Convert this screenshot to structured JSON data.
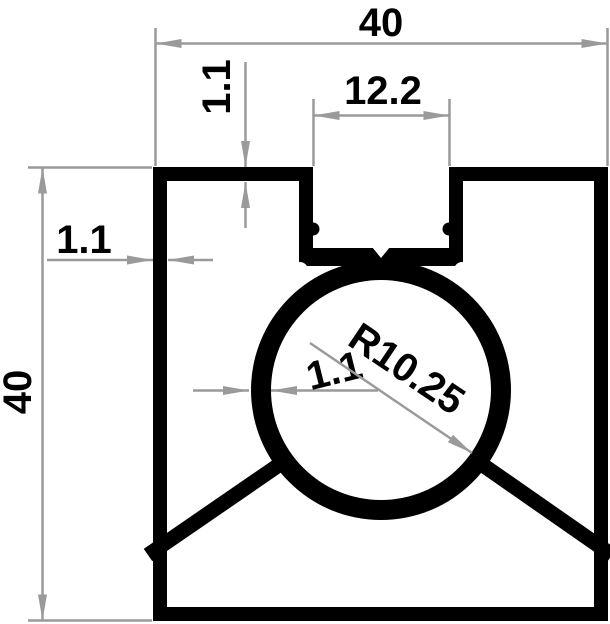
{
  "drawing": {
    "kind": "extrusion-profile-cross-section",
    "labels": {
      "overall_width": "40",
      "overall_height": "40",
      "slot_width": "12.2",
      "top_wall_thickness": "1.1",
      "side_wall_thickness": "1.1",
      "bore_wall_thickness": "1.1",
      "bore_radius": "R10.25"
    },
    "colors": {
      "profile": "#000000",
      "dimension_lines": "#9a9a9a",
      "label_text": "#000000",
      "background": "#ffffff"
    }
  }
}
